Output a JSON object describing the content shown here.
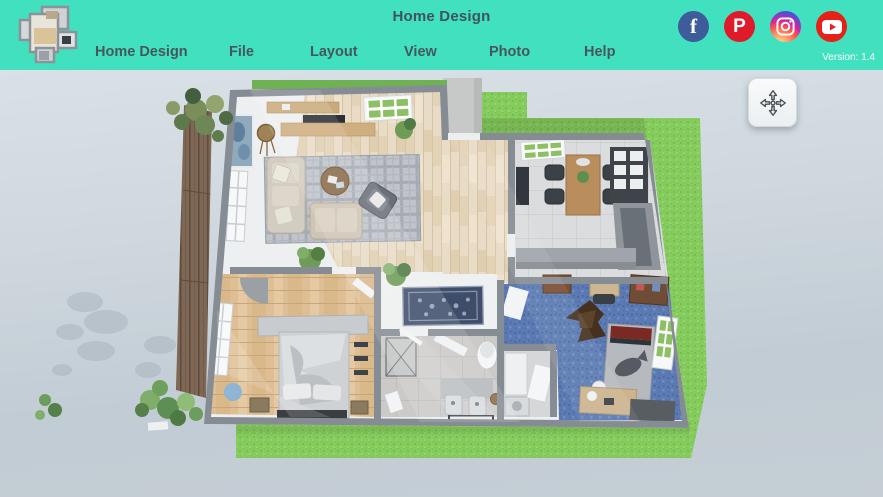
{
  "header": {
    "title": "Home Design",
    "menu": [
      {
        "label": "Home Design"
      },
      {
        "label": "File"
      },
      {
        "label": "Layout"
      },
      {
        "label": "View"
      },
      {
        "label": "Photo"
      },
      {
        "label": "Help"
      }
    ],
    "version": "Version: 1.4",
    "colors": {
      "background": "#41e1c0",
      "text": "#46565e"
    },
    "social": [
      {
        "name": "facebook-icon",
        "glyph": "f",
        "color": "#3e5c9a"
      },
      {
        "name": "pinterest-icon",
        "glyph": "P",
        "color": "#e01a2b"
      },
      {
        "name": "instagram-icon",
        "glyph": "",
        "color": "#d6249f"
      },
      {
        "name": "youtube-icon",
        "glyph": "",
        "color": "#e62117"
      }
    ]
  },
  "viewport": {
    "colors": {
      "grass": "#85cb5d",
      "walls": "#868c93",
      "living_wood": "#e9dcc6",
      "bedroom_wood": "#debf95",
      "kids_carpet": "#5b7ab3",
      "deck_wood": "#7e6755",
      "background_top": "#d9e1e7",
      "background_bottom": "#c2ccd4"
    }
  }
}
